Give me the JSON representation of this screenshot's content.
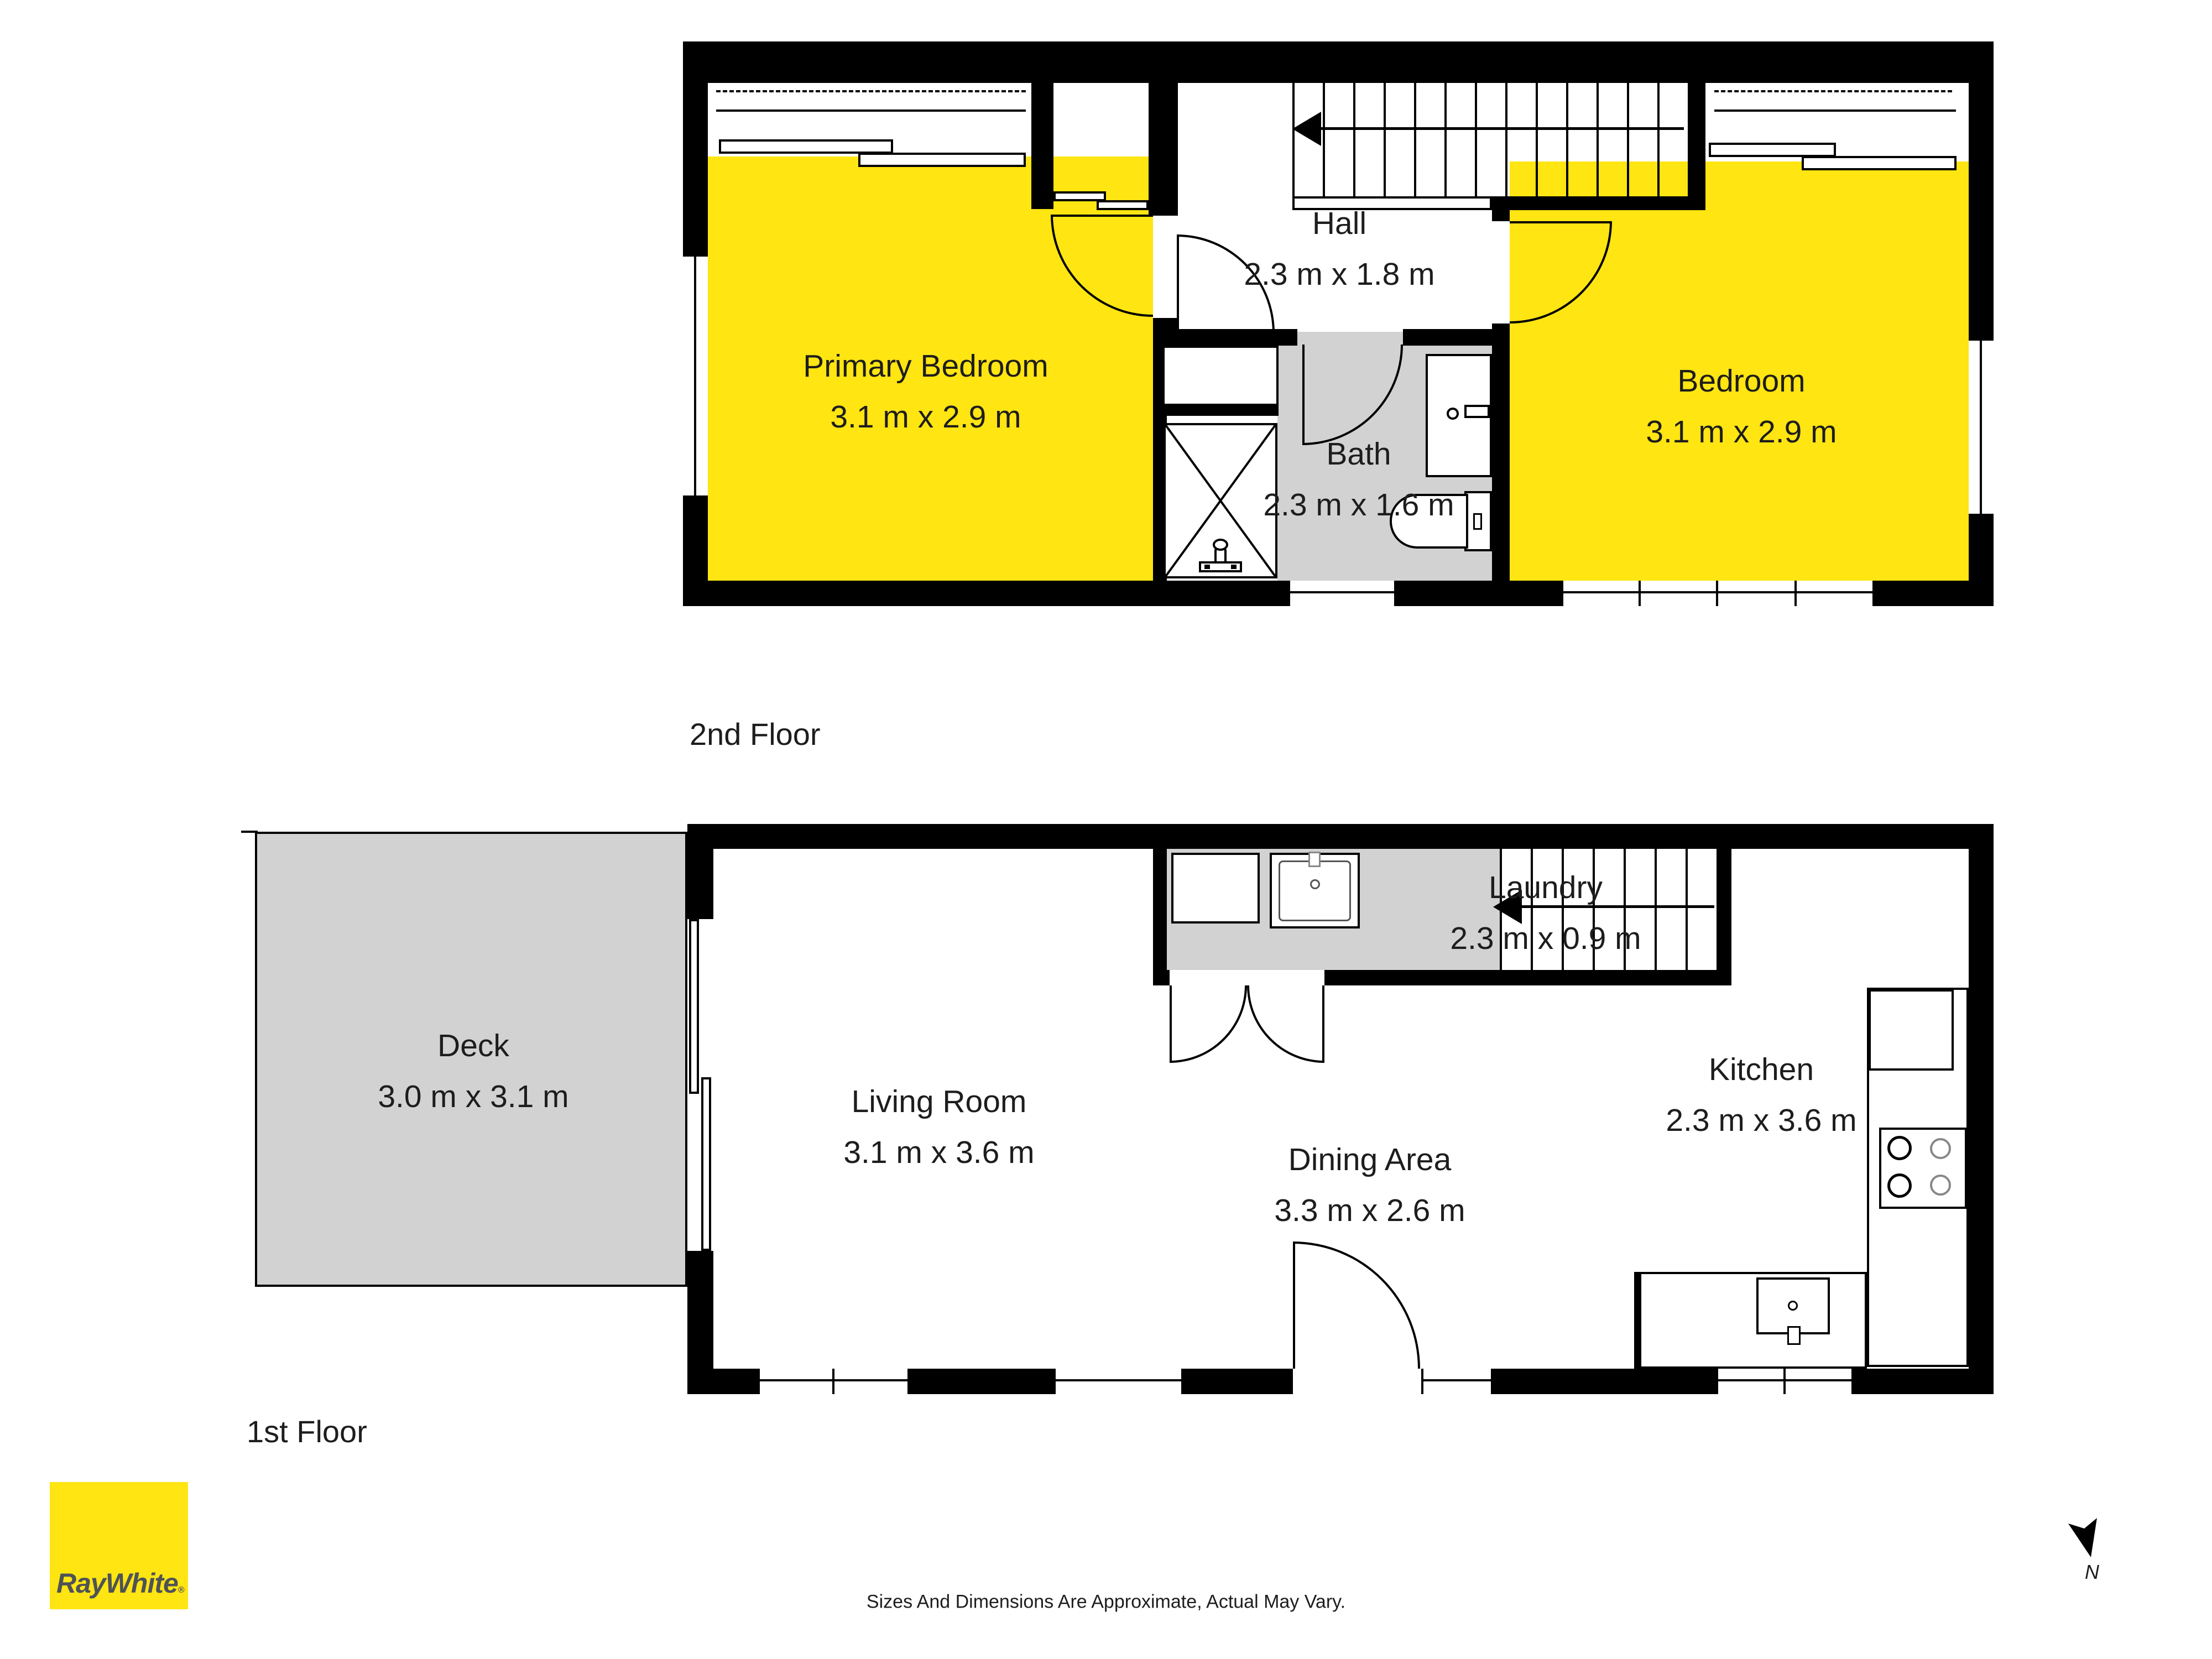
{
  "floors": [
    {
      "label": "2nd Floor",
      "rooms": [
        {
          "name": "Primary Bedroom",
          "dims": "3.1 m x 2.9 m"
        },
        {
          "name": "Hall",
          "dims": "2.3 m x 1.8 m"
        },
        {
          "name": "Bath",
          "dims": "2.3 m x 1.6 m"
        },
        {
          "name": "Bedroom",
          "dims": "3.1 m x 2.9 m"
        }
      ]
    },
    {
      "label": "1st Floor",
      "rooms": [
        {
          "name": "Deck",
          "dims": "3.0 m x 3.1 m"
        },
        {
          "name": "Living Room",
          "dims": "3.1 m x 3.6 m"
        },
        {
          "name": "Laundry",
          "dims": "2.3 m x 0.9 m"
        },
        {
          "name": "Dining Area",
          "dims": "3.3 m x 2.6 m"
        },
        {
          "name": "Kitchen",
          "dims": "2.3 m x 3.6 m"
        }
      ]
    }
  ],
  "footer": {
    "disclaimer": "Sizes And Dimensions Are Approximate, Actual May Vary."
  },
  "logo": {
    "brand": "RayWhite",
    "registered": "®"
  },
  "compass": {
    "label": "N"
  },
  "colors": {
    "highlight_yellow": "#FFE512",
    "floor_gray": "#D2D2D2",
    "wall_black": "#000000",
    "text": "#1D1D1D",
    "logo_text": "#4E5356"
  }
}
